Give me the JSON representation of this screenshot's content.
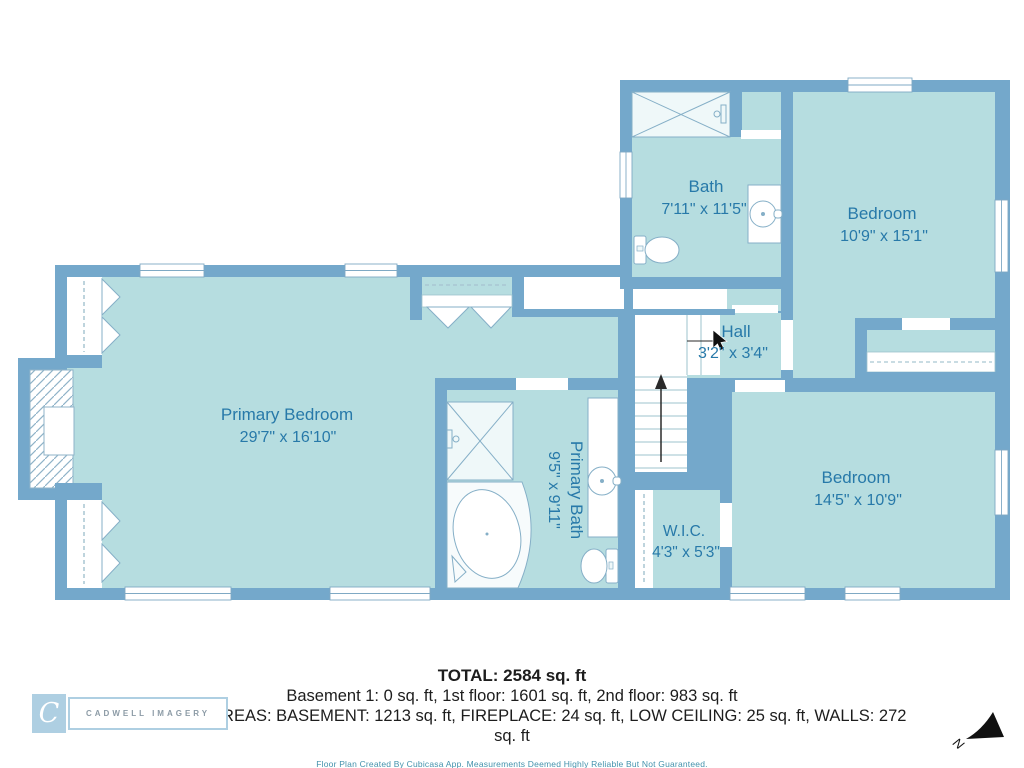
{
  "rooms": {
    "primary_bedroom": {
      "name": "Primary Bedroom",
      "dims": "29'7\" x 16'10\""
    },
    "primary_bath": {
      "name": "Primary Bath",
      "dims": "9'5\" x 9'11\""
    },
    "bath": {
      "name": "Bath",
      "dims": "7'11\" x 11'5\""
    },
    "hall": {
      "name": "Hall",
      "dims": "3'2\" x 3'4\""
    },
    "bedroom_top": {
      "name": "Bedroom",
      "dims": "10'9\" x 15'1\""
    },
    "bedroom_bottom": {
      "name": "Bedroom",
      "dims": "14'5\" x 10'9\""
    },
    "wic": {
      "name": "W.I.C.",
      "dims": "4'3\" x 5'3\""
    }
  },
  "compass": {
    "label": "N"
  },
  "summary": {
    "total": "TOTAL: 2584 sq. ft",
    "floors": "Basement 1: 0 sq. ft, 1st floor: 1601 sq. ft, 2nd floor: 983 sq. ft",
    "excluded": "EXCLUDED AREAS: BASEMENT: 1213 sq. ft, FIREPLACE: 24 sq. ft, LOW CEILING: 25 sq. ft, WALLS: 272 sq. ft",
    "disclaimer": "Floor Plan Created By Cubicasa App. Measurements Deemed Highly Reliable But Not Guaranteed."
  },
  "logo": {
    "initial": "C",
    "name": "CADWELL IMAGERY"
  },
  "colors": {
    "wall": "#74A8CB",
    "room_fill": "#B6DDE0",
    "fixture_fill": "#EFF8F9",
    "fixture_stroke": "#85AFC7",
    "label_text": "#2779A9",
    "disclaimer_text": "#4492AC",
    "logo_blue": "#AECFE2"
  }
}
